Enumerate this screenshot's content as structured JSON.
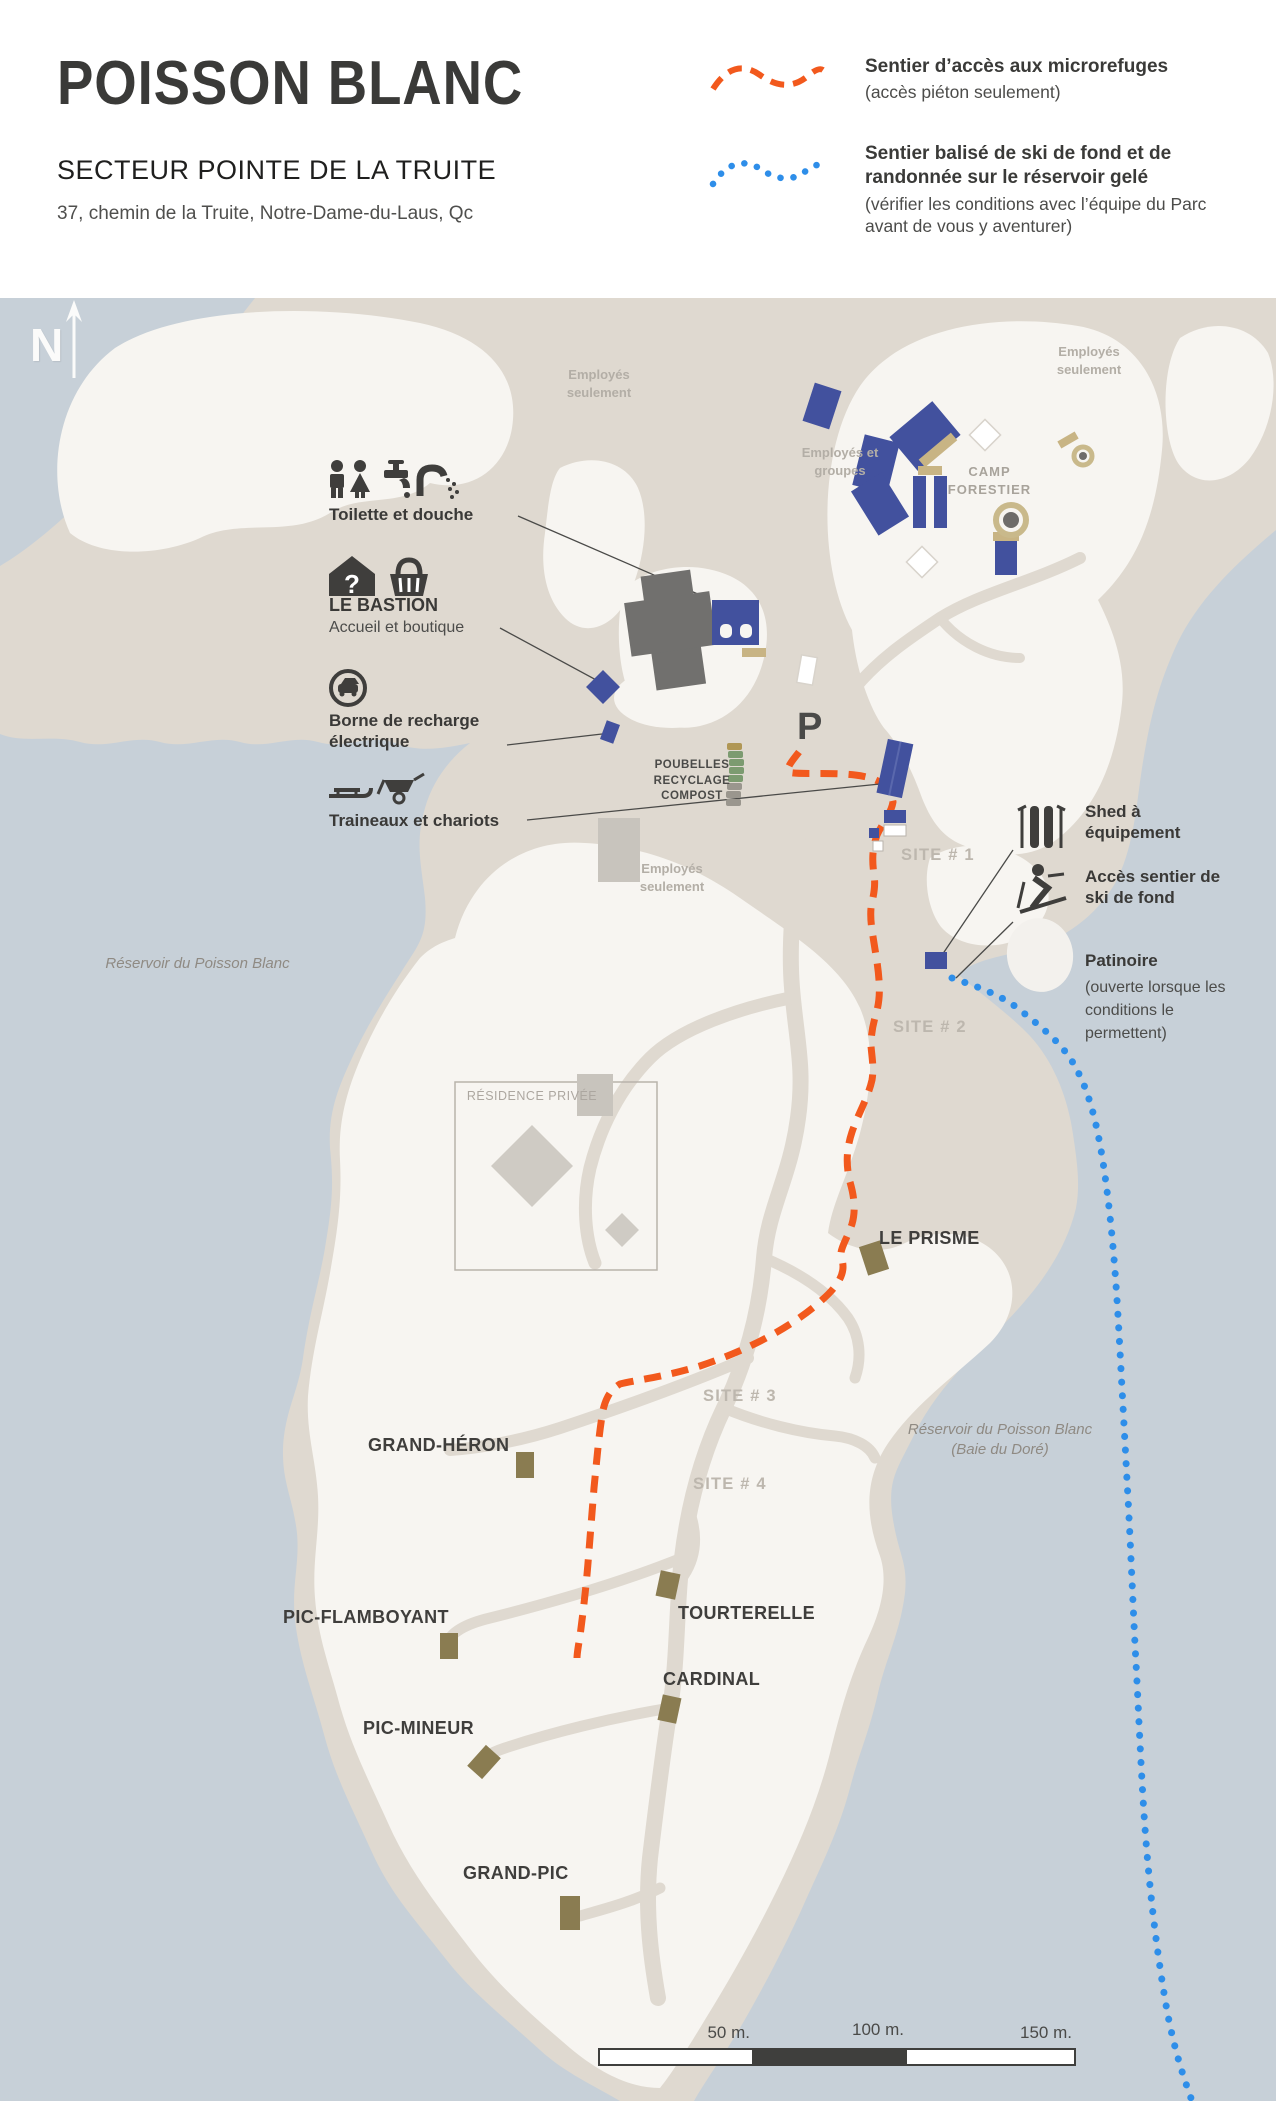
{
  "header": {
    "title": "POISSON BLANC",
    "subtitle": "SECTEUR POINTE DE LA TRUITE",
    "address": "37, chemin de la Truite, Notre-Dame-du-Laus, Qc"
  },
  "colors": {
    "trail_access": "#f2591d",
    "trail_ski": "#2e8ee9",
    "building_blue": "#42519e",
    "cabin_khaki": "#8a7c51",
    "water": "#c7d0d8"
  },
  "legend": {
    "trail_access": {
      "label": "Sentier d’accès aux microrefuges",
      "sublabel": "(accès piéton seulement)"
    },
    "trail_ski": {
      "label": "Sentier balisé de ski de fond et de randonnée sur le réservoir gelé",
      "sublabel": "(vérifier les conditions avec l’équipe du Parc avant de vous y aventurer)"
    }
  },
  "annotations": {
    "toilette": {
      "label": "Toilette et douche"
    },
    "bastion": {
      "label": "LE BASTION",
      "sublabel": "Accueil et boutique"
    },
    "borne": {
      "label": "Borne de recharge électrique"
    },
    "traineaux": {
      "label": "Traineaux et chariots"
    },
    "shed": {
      "label": "Shed à équipement"
    },
    "acces_ski": {
      "label": "Accès sentier de ski de fond"
    },
    "patinoire": {
      "label": "Patinoire",
      "sublabel": "(ouverte lorsque les conditions le permettent)"
    }
  },
  "map": {
    "compass": "N",
    "parking": "P",
    "zones": {
      "employes_top": "Employés seulement",
      "employes_topright": "Employés seulement",
      "employes_groupes": "Employés et groupes",
      "employes_mid": "Employés seulement",
      "camp_forestier": "CAMP FORESTIER",
      "poubelles": "POUBELLES RECYCLAGE COMPOST",
      "residence": "RÉSIDENCE PRIVÉE",
      "reservoir": "Réservoir du Poisson Blanc",
      "baie": "Réservoir du Poisson Blanc (Baie du Doré)"
    },
    "sites": {
      "site1": "SITE # 1",
      "site2": "SITE # 2",
      "site3": "SITE # 3",
      "site4": "SITE # 4"
    },
    "cabins": {
      "prisme": "LE PRISME",
      "heron": "GRAND-HÉRON",
      "tourterelle": "TOURTERELLE",
      "flamboyant": "PIC-FLAMBOYANT",
      "cardinal": "CARDINAL",
      "mineur": "PIC-MINEUR",
      "grandpic": "GRAND-PIC"
    },
    "scale": {
      "m50": "50 m.",
      "m100": "100 m.",
      "m150": "150 m."
    }
  }
}
